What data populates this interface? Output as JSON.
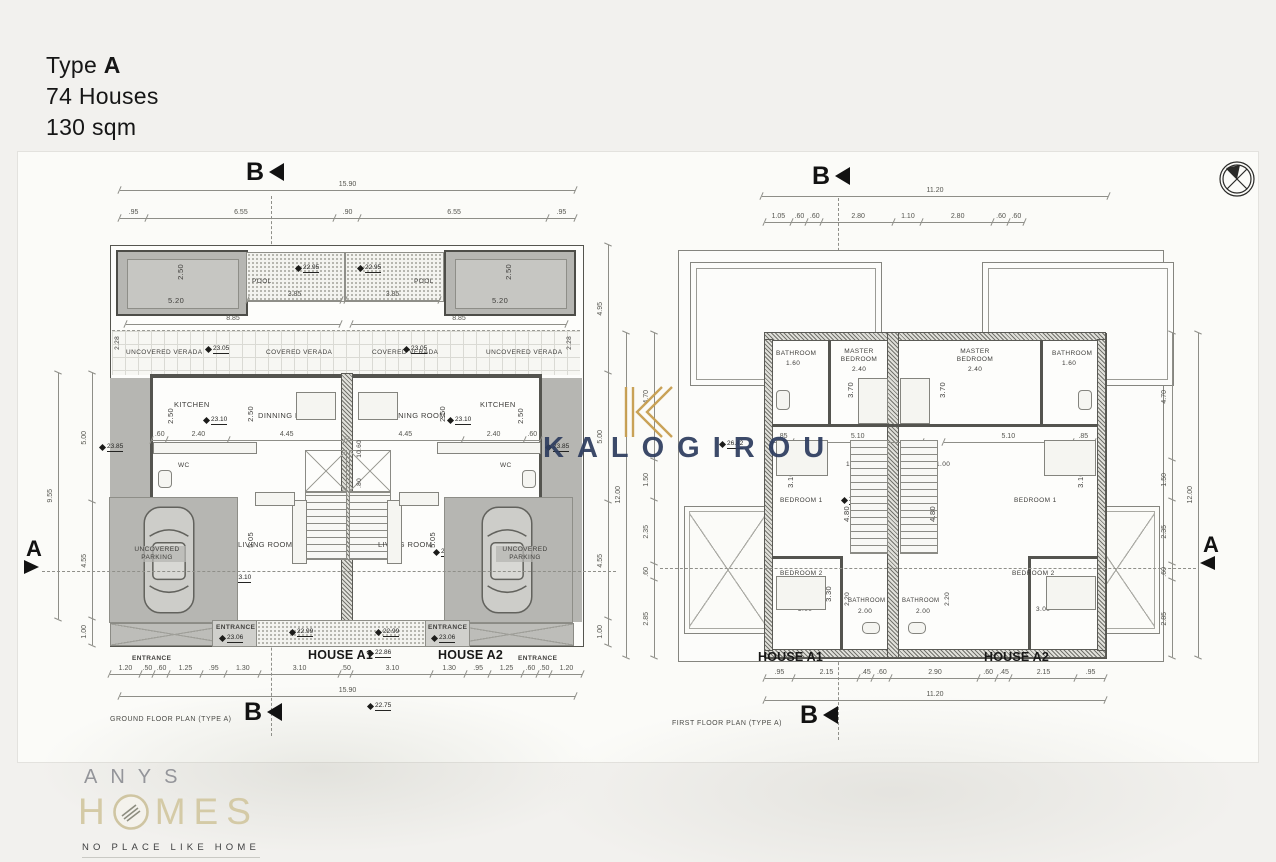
{
  "title": {
    "type_prefix": "Type",
    "type_letter": "A",
    "houses": "74 Houses",
    "area": "130 sqm"
  },
  "watermark": {
    "brand": "KALOGIROU"
  },
  "brand": {
    "name": "ANYS",
    "homes_h": "H",
    "homes_rest": "MES",
    "tagline": "NO PLACE LIKE HOME"
  },
  "markers": {
    "section_a": "A",
    "section_b": "B"
  },
  "ground_plan": {
    "caption": "GROUND FLOOR PLAN (TYPE A)",
    "house_a1": "HOUSE A1",
    "house_a2": "HOUSE A2",
    "rooms": {
      "pool": "POOL",
      "uncovered_verada": "UNCOVERED VERADA",
      "covered_verada": "COVERED VERADA",
      "kitchen": "KITCHEN",
      "dinning": "DINNING ROOM",
      "wc": "WC",
      "living": "LIVING ROOM",
      "tv": "TV",
      "parking": "UNCOVERED PARKING",
      "entrance": "ENTRANCE"
    },
    "dims": {
      "top_total": "15.90",
      "top_segments": [
        ".95",
        "6.55",
        ".90",
        "6.55",
        ".95"
      ],
      "bottom_segments": [
        "1.20",
        ".50",
        ".60",
        "1.25",
        ".95",
        "1.30",
        "3.10",
        ".50",
        "3.10",
        "1.30",
        ".95",
        "1.25",
        ".60",
        ".50",
        "1.20"
      ],
      "bottom_total": "15.90",
      "left_total": "9.55",
      "left_segments": [
        "5.00",
        "4.55",
        "1.00"
      ],
      "right_segments": [
        "4.95",
        "5.00",
        "4.55",
        "1.00"
      ],
      "pool_w": "3.85",
      "pool_len": "5.20",
      "pool_d": "2.50",
      "deck": "8.85",
      "verada_d": "2.28",
      "kitchen_d": "2.50",
      "kitchen_row": [
        ".60",
        "2.40",
        "4.45"
      ],
      "kitchen_row_m": [
        "4.45",
        "2.40",
        ".60"
      ],
      "dining_d": "2.50",
      "hall_l": "10.60",
      "hall_w": ".80",
      "living_d": "5.05"
    },
    "elev": {
      "verada": "23.05",
      "kitchen": "23.10",
      "pool": "22.95",
      "living": "23.10",
      "entrance": "23.06",
      "walk": "22.99",
      "yard": "23.85",
      "porch": "22.86",
      "street": "22.75"
    }
  },
  "first_plan": {
    "caption": "FIRST FLOOR PLAN (TYPE A)",
    "house_a1": "HOUSE A1",
    "house_a2": "HOUSE A2",
    "rooms": {
      "bathroom": "BATHROOM",
      "master": "MASTER BEDROOM",
      "bedroom1": "BEDROOM 1",
      "bedroom2": "BEDROOM 2"
    },
    "dims": {
      "top_total": "11.20",
      "top_segments": [
        "1.05",
        ".60",
        ".60",
        "2.80",
        "1.10",
        "2.80",
        ".60",
        ".60"
      ],
      "bottom_segments": [
        ".95",
        "2.15",
        ".45",
        ".60",
        "2.90",
        ".60",
        ".45",
        "2.15",
        ".95"
      ],
      "bottom_total": "11.20",
      "side_segments": [
        "4.70",
        "1.50",
        "2.35",
        ".60",
        "2.85"
      ],
      "side_total": "12.00",
      "bath_w": "1.60",
      "master_w": "2.40",
      "master_d": "3.70",
      "mid_left": [
        ".85",
        "5.10"
      ],
      "mid_right": [
        "5.10",
        ".85"
      ],
      "bed1_w": "3.00",
      "bed1_d": "3.10",
      "land_a": "1.00",
      "land_b": "1.10",
      "stair_d": "4.80",
      "bed2_d": "3.30",
      "bed2_w": "3.00",
      "bath2_w": "2.00",
      "bath2_d": "2.20"
    },
    "elev": {
      "landing": "26.42",
      "stair": "26.52"
    }
  }
}
